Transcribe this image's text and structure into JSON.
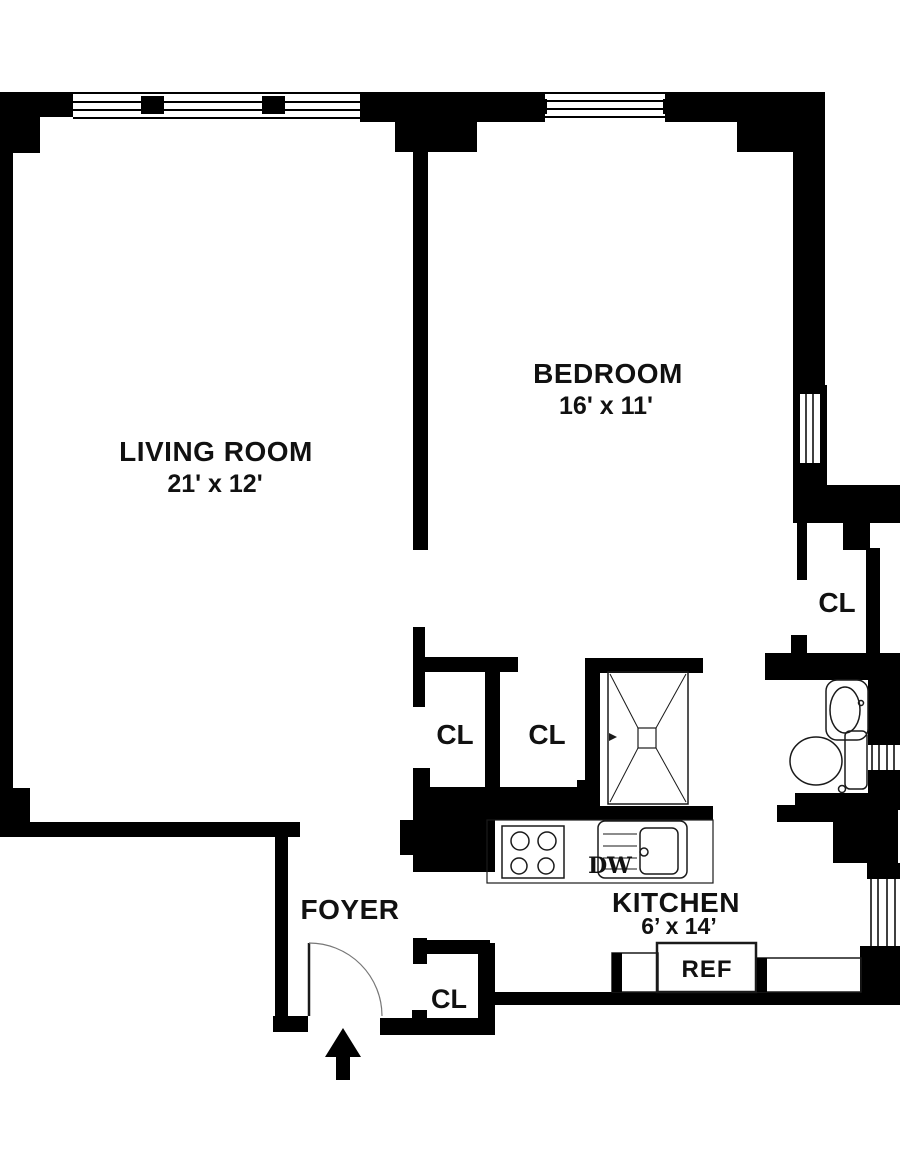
{
  "plan": {
    "title": "one-bedroom apartment floor plan",
    "rooms": {
      "living_room": {
        "name": "LIVING ROOM",
        "dims": "21' x 12'"
      },
      "bedroom": {
        "name": "BEDROOM",
        "dims": "16' x 11'"
      },
      "kitchen": {
        "name": "KITCHEN",
        "dims": "6’ x 14’"
      },
      "foyer": {
        "name": "FOYER"
      }
    },
    "closets": {
      "closet_hall_left": "CL",
      "closet_hall_mid": "CL",
      "closet_right_wing": "CL",
      "closet_foyer": "CL"
    },
    "appliances": {
      "dishwasher": "DW",
      "refrigerator": "REF"
    },
    "colors": {
      "wall": "#000000",
      "background": "#ffffff",
      "fixture_line": "#1a1a1a"
    }
  }
}
